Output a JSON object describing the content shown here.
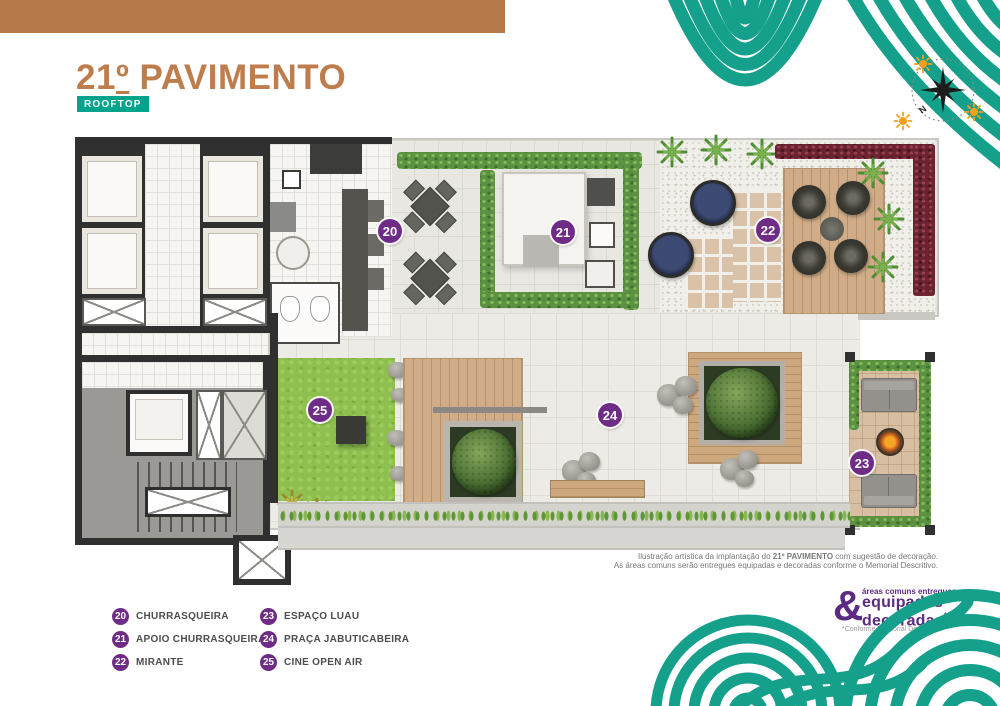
{
  "header": {
    "bar_color": "#b5794a",
    "title_number": "21",
    "title_ordinal": "º",
    "title_rest": " PAVIMENTO",
    "title_color": "#bd7d4d",
    "subtitle": "ROOFTOP",
    "subtitle_bg": "#00a48c"
  },
  "compass": {
    "north": "N"
  },
  "legend": {
    "badge_color": "#6f2c86",
    "items": [
      {
        "number": "20",
        "label": "CHURRASQUEIRA"
      },
      {
        "number": "21",
        "label": "APOIO CHURRASQUEIRA"
      },
      {
        "number": "22",
        "label": "MIRANTE"
      },
      {
        "number": "23",
        "label": "ESPAÇO LUAU"
      },
      {
        "number": "24",
        "label": "PRAÇA JABUTICABEIRA"
      },
      {
        "number": "25",
        "label": "CINE OPEN AIR"
      }
    ]
  },
  "disclaimer": {
    "line1_a": "Ilustração artística da implantação do ",
    "line1_b": "21º PAVIMENTO",
    "line1_c": " com sugestão de decoração.",
    "line2": "As áreas comuns serão entregues equipadas e decoradas conforme o Memorial Descritivo."
  },
  "stamp": {
    "ampersand": "&",
    "tagline": "áreas comuns entregues",
    "word1": "equipadas",
    "word2": "decoradas",
    "asterisk": "*",
    "footnote": "*Conforme Memorial Descritivo",
    "color": "#5b2b82"
  },
  "decor": {
    "wave_color": "#14a08a",
    "sun_color": "#f6a01c"
  }
}
